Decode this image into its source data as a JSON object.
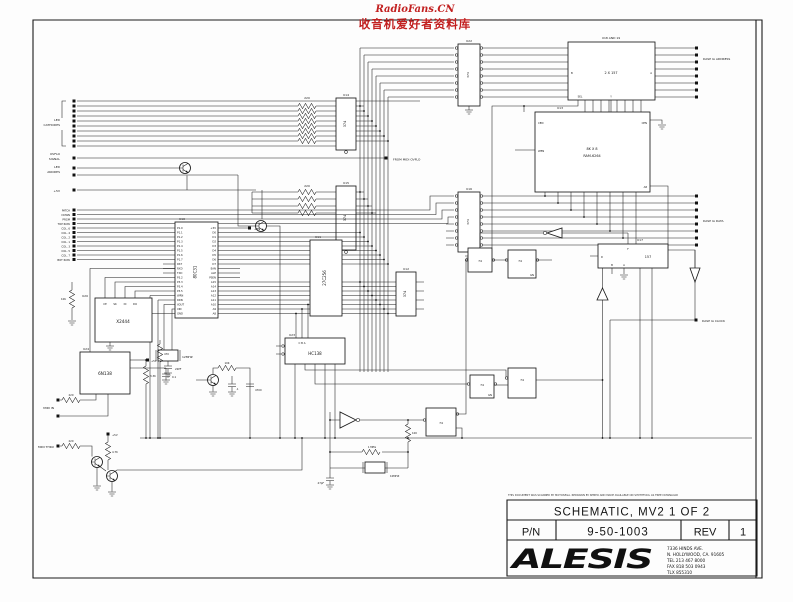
{
  "watermark": {
    "line1": "RadioFans.CN",
    "line2": "收音机爱好者资料库"
  },
  "left_labels": {
    "led1": "LED",
    "led2": "CATHODES",
    "ov1": "OVFLO",
    "ov2": "SIGNAL",
    "an1": "LED",
    "an2": "ANODES",
    "plus5v": "+5V",
    "rows": [
      "PATCH",
      "DOWN",
      "PRGM",
      "TOP ROW",
      "COL. 6",
      "COL. 4",
      "COL. 2",
      "COL. 1",
      "COL. 3",
      "COL. 5",
      "COL. 7",
      "BOT ROW"
    ],
    "midi_in": "MIDI IN",
    "midi_thru": "MIDI THRU"
  },
  "right_labels": {
    "dasp_address": "DASP IA ADDRESS",
    "dasp_data": "DASP IA DATA",
    "dasp_clock": "DASP IA CLOCK"
  },
  "net_labels": {
    "from_midi": "FROM MIDI OVFLO",
    "plus5v_mcu": "+5V",
    "plus5v_opto": "+5V",
    "plus5v_thru": "+5V"
  },
  "ics": {
    "u14": {
      "ref": "U14",
      "part": "374"
    },
    "u15": {
      "ref": "U15",
      "part": "374"
    },
    "u12": {
      "ref": "U12",
      "part": "374"
    },
    "u22": {
      "ref": "U22",
      "part": "374"
    },
    "u16": {
      "ref": "U16",
      "part": "374"
    },
    "mcu": {
      "ref": "U10",
      "part": "80C31",
      "pins_left": [
        "P1.0",
        "P1.1",
        "P1.2",
        "P1.3",
        "P1.4",
        "P1.5",
        "P1.6",
        "P1.7",
        "RST",
        "RXD",
        "TXD",
        "P3.2",
        "P3.3",
        "P3.4",
        "P3.5",
        "WRN",
        "RDN",
        "XOUT",
        "XIN",
        "GND"
      ],
      "pins_right": [
        "+5V",
        "D0",
        "D1",
        "D2",
        "D3",
        "D4",
        "D5",
        "D6",
        "D7",
        "EAN",
        "ALE",
        "PSEN",
        "A15",
        "A14",
        "A13",
        "A12",
        "A11",
        "A10",
        "A9",
        "A8"
      ]
    },
    "eprom": {
      "ref": "U11",
      "part": "27C256"
    },
    "decoder": {
      "ref": "U23",
      "part": "HC138",
      "pins_top": "C  B  A"
    },
    "mux": {
      "ref": "U18 AND 19",
      "part": "2 X 157",
      "pin_b": "B",
      "pin_a": "A",
      "pin_sel": "SEL",
      "pin_y": "Y"
    },
    "ram": {
      "ref": "U13",
      "part_line1": "8K X 8",
      "part_line2": "RAM-6264",
      "pin_cen_left": "CEN",
      "pin_cen_right": "CEN",
      "pin_wen": "WEN",
      "pin_a8": "A8"
    },
    "u17": {
      "ref": "U17",
      "part": "157",
      "pin_f": "F",
      "pin_d": "D",
      "pin_b": "B",
      "pin_a": "A"
    },
    "ff": {
      "part": "74",
      "pin_gn": "GN"
    },
    "novram": {
      "ref": "U20",
      "part": "X2444",
      "pin_ce": "CE",
      "pin_sk": "SK",
      "pin_di": "DI",
      "pin_do": "DO"
    },
    "opto": {
      "ref": "U24",
      "part": "6N138"
    }
  },
  "passives": {
    "rpack1": "220",
    "rpack2": "220",
    "xtal_mcu": "12MHZ",
    "c22pf": "22PF",
    "r470": "470",
    "r10k_a": "10K",
    "r10k_b": "10K",
    "r33k": "3.3K",
    "c01": "0.1",
    "cdot1": ".1",
    "c4700": "4700",
    "r220_in": "220",
    "r220_thru": "220",
    "r47k": "4.7K",
    "r100": "100",
    "r1meg": "1 MEG",
    "xtal_osc": "10MHZ",
    "c47pf": "47pF"
  },
  "title_block": {
    "disclaimer": "THIS DOCUMENT WAS SCANNED BY MOTOSEGA. REDRAWN BY SEMEO AND MADE AVAILABLE ON SYNTHFOOL AS FREE DOWNLOAD",
    "title": "SCHEMATIC, MV2  1 OF 2",
    "pn_label": "P/N",
    "pn_value": "9-50-1003",
    "rev_label": "REV",
    "rev_value": "1",
    "logo": "ALESIS",
    "address": [
      "7336 HINDS AVE.",
      "N. HOLLYWOOD, CA. 91605",
      "TEL 213 467 8000",
      "FAX 818 503 0943",
      "TLX 855310"
    ]
  }
}
